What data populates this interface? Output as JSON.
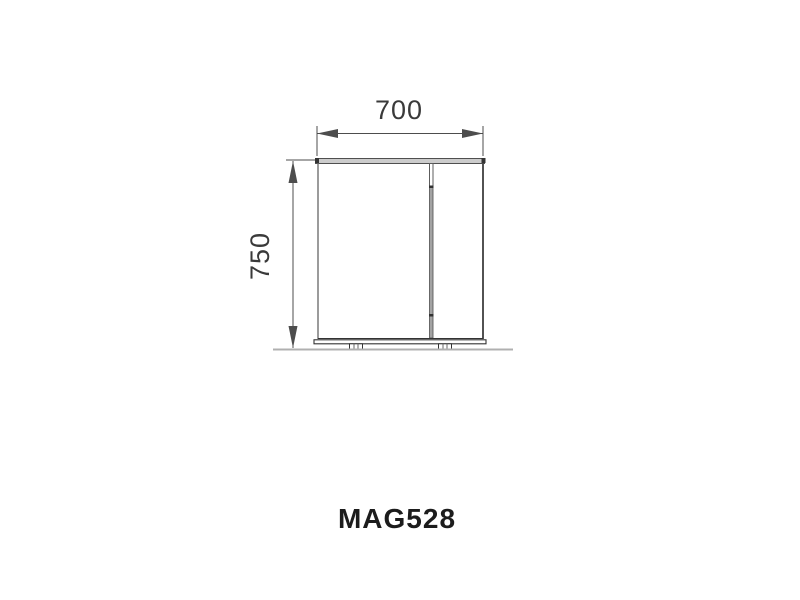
{
  "drawing": {
    "product_code": "MAG528",
    "view": "cabinet-front-elevation",
    "width_dimension": {
      "label": "700"
    },
    "height_dimension": {
      "label": "750"
    }
  },
  "colors": {
    "dimension_line": "#4d4d4d",
    "dimension_text": "#3a3a3a",
    "title_text": "#1c1c1c",
    "panel_fill": "#cccccc",
    "divider_fill": "#a3a3a3",
    "outline_dark": "#333333",
    "ground_line": "#b0b0b0",
    "page_bg": "#ffffff"
  }
}
